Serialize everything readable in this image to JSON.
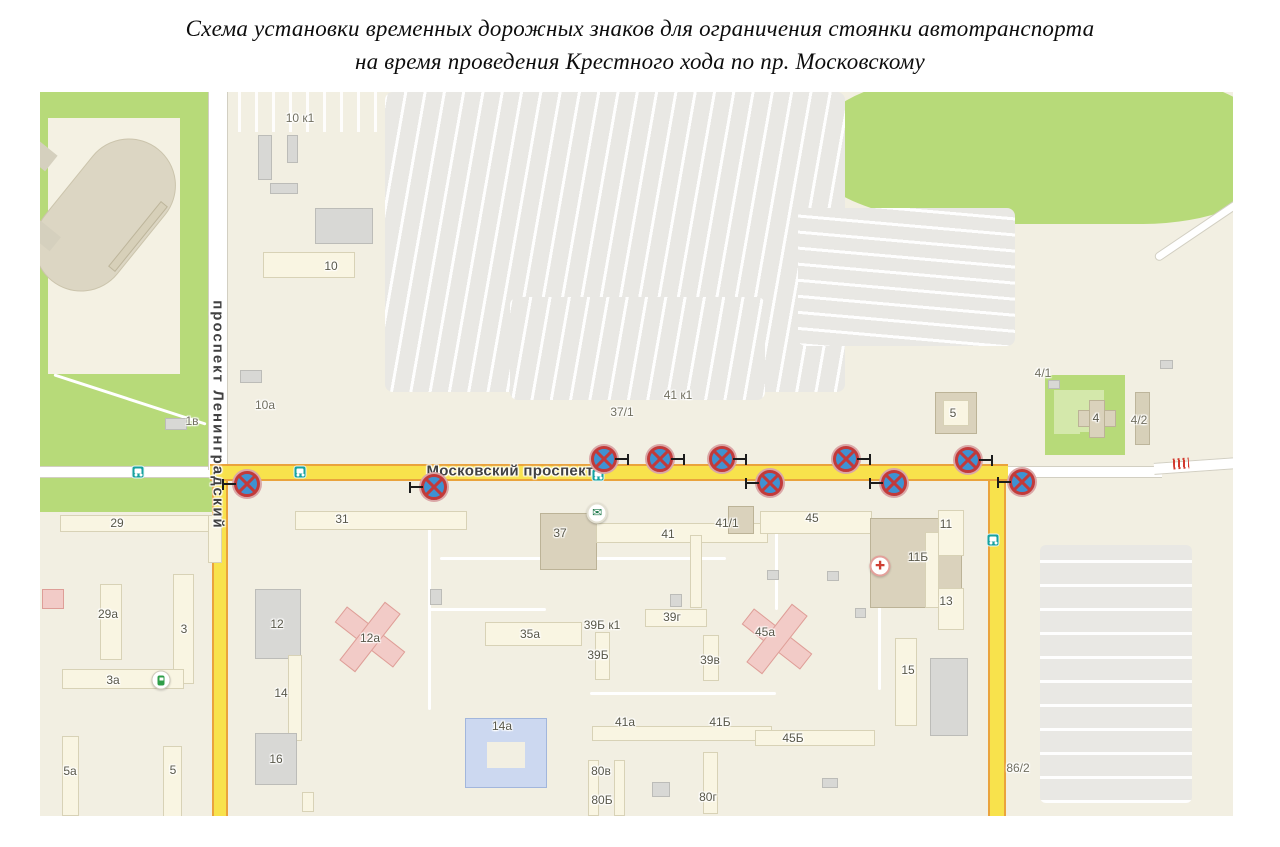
{
  "title": {
    "line1": "Схема установки временных дорожных знаков для ограничения стоянки автотранспорта",
    "line2": "на время проведения Крестного хода по пр. Московскому"
  },
  "map": {
    "colors": {
      "route_fill": "#f8e24c",
      "route_border": "#eaa33c",
      "sign_blue": "#3f92d2",
      "sign_red": "#c23a3a",
      "park_green": "#b7da79",
      "map_bg": "#f2efe2"
    },
    "shapes": [
      {
        "k": "green",
        "n": "park-area",
        "x": 0,
        "y": 0,
        "w": 175,
        "h": 420
      },
      {
        "k": "ivory",
        "n": "stadium-grounds",
        "x": 8,
        "y": 26,
        "w": 132,
        "h": 256
      },
      {
        "k": "oval",
        "n": "stadium-track",
        "x": -20,
        "y": 76,
        "w": 170,
        "h": 94,
        "r": "48px",
        "rot": -51
      },
      {
        "k": "tanbar",
        "n": "grandstand",
        "x": 56,
        "y": 140,
        "w": 84,
        "h": 9,
        "rot": -51
      },
      {
        "k": "grayblk",
        "x": -8,
        "y": 52,
        "w": 20,
        "h": 24,
        "rot": -51
      },
      {
        "k": "grayblk",
        "x": -10,
        "y": 118,
        "w": 18,
        "h": 42,
        "rot": -51
      },
      {
        "k": "path",
        "x": 10,
        "y": 306,
        "w": 160,
        "h": 3,
        "rot": 18
      },
      {
        "k": "green",
        "n": "park-area-northeast",
        "x": 768,
        "y": -14,
        "w": 458,
        "h": 146,
        "r": "45% 40% 42% 58% / 80% 65% 55% 75%"
      },
      {
        "k": "green",
        "n": "green-plot-4",
        "x": 1005,
        "y": 283,
        "w": 80,
        "h": 80
      },
      {
        "k": "greenlight",
        "x": 1014,
        "y": 298,
        "w": 50,
        "h": 44
      },
      {
        "k": "green",
        "x": 1040,
        "y": 340,
        "w": 30,
        "h": 20
      },
      {
        "k": "parking pa",
        "n": "parking-lot-north",
        "x": 345,
        "y": 0,
        "w": 460,
        "h": 300,
        "r": "8px"
      },
      {
        "k": "parking pa",
        "x": 470,
        "y": 205,
        "w": 255,
        "h": 103,
        "r": "8px"
      },
      {
        "k": "parking pb",
        "x": 758,
        "y": 116,
        "w": 217,
        "h": 138,
        "r": "8px"
      },
      {
        "k": "parking pc",
        "n": "parking-lot-south",
        "x": 1000,
        "y": 453,
        "w": 152,
        "h": 258,
        "r": "6px"
      },
      {
        "k": "stripesv",
        "x": 198,
        "y": 0,
        "w": 148,
        "h": 40
      },
      {
        "k": "path",
        "x": 388,
        "y": 426,
        "w": 3,
        "h": 192
      },
      {
        "k": "path",
        "x": 390,
        "y": 516,
        "w": 116,
        "h": 3
      },
      {
        "k": "path",
        "x": 400,
        "y": 465,
        "w": 286,
        "h": 3
      },
      {
        "k": "path",
        "x": 735,
        "y": 428,
        "w": 3,
        "h": 90
      },
      {
        "k": "path",
        "x": 838,
        "y": 514,
        "w": 3,
        "h": 84
      },
      {
        "k": "path",
        "x": 550,
        "y": 600,
        "w": 186,
        "h": 3
      },
      {
        "k": "roadh",
        "n": "road-west",
        "x": 0,
        "y": 374,
        "w": 178,
        "h": 12
      },
      {
        "k": "roadh",
        "n": "road-east",
        "x": 962,
        "y": 374,
        "w": 160,
        "h": 12
      },
      {
        "k": "roadh",
        "n": "road-east-bend",
        "x": 1114,
        "y": 368,
        "w": 82,
        "h": 12,
        "rot": -4
      },
      {
        "k": "roadv",
        "n": "road-leningradsky",
        "x": 168,
        "y": 0,
        "w": 20,
        "h": 378
      },
      {
        "k": "roaddiag",
        "n": "road-northeast",
        "x": 1106,
        "y": 131,
        "w": 112,
        "h": 9,
        "rot": -34,
        "r": "5px"
      },
      {
        "k": "routev",
        "n": "route-highlight-left",
        "x": 172,
        "y": 374,
        "w": 16,
        "h": 350
      },
      {
        "k": "routev",
        "n": "route-highlight-right",
        "x": 948,
        "y": 374,
        "w": 18,
        "h": 350
      },
      {
        "k": "routeh",
        "n": "route-highlight-moskovsky",
        "x": 170,
        "y": 372,
        "w": 798,
        "h": 17
      },
      {
        "k": "hatch",
        "n": "crossing-marker",
        "x": 1133,
        "y": 366,
        "w": 16,
        "h": 11,
        "rot": -4
      },
      {
        "k": "gray",
        "x": 218,
        "y": 43,
        "w": 14,
        "h": 45
      },
      {
        "k": "gray",
        "x": 247,
        "y": 43,
        "w": 11,
        "h": 28
      },
      {
        "k": "gray",
        "x": 230,
        "y": 91,
        "w": 28,
        "h": 11
      },
      {
        "k": "gray",
        "x": 275,
        "y": 116,
        "w": 58,
        "h": 36
      },
      {
        "k": "pale",
        "n": "building-10",
        "x": 223,
        "y": 160,
        "w": 92,
        "h": 26
      },
      {
        "k": "gray",
        "x": 200,
        "y": 278,
        "w": 22,
        "h": 13
      },
      {
        "k": "gray",
        "x": 125,
        "y": 326,
        "w": 22,
        "h": 12
      },
      {
        "k": "pale",
        "x": 20,
        "y": 423,
        "w": 162,
        "h": 17
      },
      {
        "k": "pale",
        "x": 168,
        "y": 423,
        "w": 14,
        "h": 48
      },
      {
        "k": "pale",
        "x": 60,
        "y": 492,
        "w": 22,
        "h": 76
      },
      {
        "k": "pink",
        "x": 2,
        "y": 497,
        "w": 22,
        "h": 20
      },
      {
        "k": "pale",
        "x": 133,
        "y": 482,
        "w": 21,
        "h": 110
      },
      {
        "k": "pale",
        "x": 22,
        "y": 577,
        "w": 122,
        "h": 20
      },
      {
        "k": "pale",
        "x": 22,
        "y": 644,
        "w": 17,
        "h": 80
      },
      {
        "k": "pale",
        "x": 123,
        "y": 654,
        "w": 19,
        "h": 78
      },
      {
        "k": "gray",
        "x": 215,
        "y": 497,
        "w": 46,
        "h": 70
      },
      {
        "k": "pale",
        "x": 248,
        "y": 563,
        "w": 14,
        "h": 86
      },
      {
        "k": "gray",
        "x": 215,
        "y": 641,
        "w": 42,
        "h": 52
      },
      {
        "k": "pale",
        "x": 262,
        "y": 700,
        "w": 12,
        "h": 20
      },
      {
        "k": "pale",
        "x": 255,
        "y": 419,
        "w": 172,
        "h": 19
      },
      {
        "k": "tan",
        "n": "building-37",
        "x": 500,
        "y": 421,
        "w": 57,
        "h": 57
      },
      {
        "k": "pale",
        "x": 556,
        "y": 431,
        "w": 172,
        "h": 20
      },
      {
        "k": "pale",
        "x": 445,
        "y": 530,
        "w": 97,
        "h": 24
      },
      {
        "k": "pale",
        "x": 555,
        "y": 540,
        "w": 15,
        "h": 48
      },
      {
        "k": "pale",
        "x": 605,
        "y": 517,
        "w": 62,
        "h": 18
      },
      {
        "k": "pale",
        "x": 663,
        "y": 543,
        "w": 16,
        "h": 46
      },
      {
        "k": "pale",
        "x": 650,
        "y": 443,
        "w": 12,
        "h": 73
      },
      {
        "k": "tan",
        "x": 688,
        "y": 414,
        "w": 26,
        "h": 28
      },
      {
        "k": "pale",
        "x": 720,
        "y": 419,
        "w": 112,
        "h": 23
      },
      {
        "k": "tan",
        "n": "building-11b",
        "x": 830,
        "y": 426,
        "w": 92,
        "h": 90
      },
      {
        "k": "pale",
        "x": 898,
        "y": 418,
        "w": 26,
        "h": 46
      },
      {
        "k": "pale",
        "x": 898,
        "y": 496,
        "w": 26,
        "h": 42
      },
      {
        "k": "pale",
        "x": 885,
        "y": 440,
        "w": 14,
        "h": 76
      },
      {
        "k": "pale",
        "x": 855,
        "y": 546,
        "w": 22,
        "h": 88
      },
      {
        "k": "gray",
        "x": 890,
        "y": 566,
        "w": 38,
        "h": 78
      },
      {
        "k": "pale",
        "x": 552,
        "y": 634,
        "w": 180,
        "h": 15
      },
      {
        "k": "pale",
        "x": 715,
        "y": 638,
        "w": 120,
        "h": 16
      },
      {
        "k": "pale",
        "x": 548,
        "y": 668,
        "w": 11,
        "h": 56
      },
      {
        "k": "pale",
        "x": 574,
        "y": 668,
        "w": 11,
        "h": 56
      },
      {
        "k": "pale",
        "x": 663,
        "y": 660,
        "w": 15,
        "h": 62
      },
      {
        "k": "gray",
        "x": 612,
        "y": 690,
        "w": 18,
        "h": 15
      },
      {
        "k": "gray",
        "x": 782,
        "y": 686,
        "w": 16,
        "h": 10
      },
      {
        "k": "blue",
        "n": "building-14a",
        "x": 425,
        "y": 626,
        "w": 82,
        "h": 70
      },
      {
        "k": "hole",
        "x": 447,
        "y": 650,
        "w": 38,
        "h": 26
      },
      {
        "k": "tan",
        "n": "building-5-right",
        "x": 895,
        "y": 300,
        "w": 42,
        "h": 42
      },
      {
        "k": "pale",
        "x": 903,
        "y": 308,
        "w": 26,
        "h": 26
      },
      {
        "k": "tanbar",
        "x": 1095,
        "y": 300,
        "w": 15,
        "h": 53
      },
      {
        "k": "tan",
        "n": "building-4",
        "x": 1038,
        "y": 318,
        "w": 38,
        "h": 17
      },
      {
        "k": "tan",
        "x": 1049,
        "y": 308,
        "w": 16,
        "h": 38
      },
      {
        "k": "gray",
        "x": 1008,
        "y": 288,
        "w": 12,
        "h": 9
      },
      {
        "k": "gray",
        "x": 1120,
        "y": 268,
        "w": 13,
        "h": 9
      },
      {
        "k": "gray",
        "x": 390,
        "y": 497,
        "w": 12,
        "h": 16
      },
      {
        "k": "gray",
        "x": 630,
        "y": 502,
        "w": 12,
        "h": 13
      },
      {
        "k": "gray",
        "x": 727,
        "y": 478,
        "w": 12,
        "h": 10
      },
      {
        "k": "gray",
        "x": 787,
        "y": 479,
        "w": 12,
        "h": 10
      },
      {
        "k": "gray",
        "x": 815,
        "y": 516,
        "w": 11,
        "h": 10
      },
      {
        "k": "pink",
        "n": "building-12a",
        "x": 293,
        "y": 535,
        "w": 74,
        "h": 20,
        "rot": 38
      },
      {
        "k": "pink",
        "x": 320,
        "y": 508,
        "w": 20,
        "h": 74,
        "rot": 38
      },
      {
        "k": "pink",
        "n": "building-45a",
        "x": 700,
        "y": 537,
        "w": 74,
        "h": 20,
        "rot": 38
      },
      {
        "k": "pink",
        "x": 727,
        "y": 510,
        "w": 20,
        "h": 74,
        "rot": 38
      }
    ],
    "labels": [
      {
        "t": "Московский проспект",
        "x": 470,
        "y": 379,
        "cls": "street",
        "n": "street-label-moskovsky-prospekt"
      },
      {
        "t": "проспект Ленинградский",
        "x": 178,
        "y": 323,
        "cls": "vstreet",
        "n": "street-label-prospekt-leningradsky"
      },
      {
        "t": "10 к1",
        "x": 260,
        "y": 26,
        "cls": "plot"
      },
      {
        "t": "10",
        "x": 291,
        "y": 174
      },
      {
        "t": "10а",
        "x": 225,
        "y": 313,
        "cls": "plot"
      },
      {
        "t": "1в",
        "x": 152,
        "y": 329,
        "cls": "plot"
      },
      {
        "t": "37/1",
        "x": 582,
        "y": 320,
        "cls": "plot"
      },
      {
        "t": "41 к1",
        "x": 638,
        "y": 303,
        "cls": "plot"
      },
      {
        "t": "4/1",
        "x": 1003,
        "y": 281,
        "cls": "plot"
      },
      {
        "t": "4",
        "x": 1056,
        "y": 326
      },
      {
        "t": "4/2",
        "x": 1099,
        "y": 328,
        "cls": "plot"
      },
      {
        "t": "5",
        "x": 913,
        "y": 321
      },
      {
        "t": "29",
        "x": 77,
        "y": 431
      },
      {
        "t": "29а",
        "x": 68,
        "y": 522
      },
      {
        "t": "3",
        "x": 144,
        "y": 537
      },
      {
        "t": "3а",
        "x": 73,
        "y": 588
      },
      {
        "t": "5а",
        "x": 30,
        "y": 679
      },
      {
        "t": "5",
        "x": 133,
        "y": 678
      },
      {
        "t": "12",
        "x": 237,
        "y": 532
      },
      {
        "t": "14",
        "x": 241,
        "y": 601
      },
      {
        "t": "16",
        "x": 236,
        "y": 667
      },
      {
        "t": "31",
        "x": 302,
        "y": 427
      },
      {
        "t": "12а",
        "x": 330,
        "y": 546
      },
      {
        "t": "35а",
        "x": 490,
        "y": 542
      },
      {
        "t": "37",
        "x": 520,
        "y": 441
      },
      {
        "t": "41",
        "x": 628,
        "y": 442
      },
      {
        "t": "39Б к1",
        "x": 562,
        "y": 533
      },
      {
        "t": "39Б",
        "x": 558,
        "y": 563
      },
      {
        "t": "39г",
        "x": 632,
        "y": 525
      },
      {
        "t": "39в",
        "x": 670,
        "y": 568
      },
      {
        "t": "41/1",
        "x": 687,
        "y": 431
      },
      {
        "t": "45",
        "x": 772,
        "y": 426
      },
      {
        "t": "45а",
        "x": 725,
        "y": 540
      },
      {
        "t": "11Б",
        "x": 878,
        "y": 465
      },
      {
        "t": "11",
        "x": 906,
        "y": 432
      },
      {
        "t": "13",
        "x": 906,
        "y": 509
      },
      {
        "t": "15",
        "x": 868,
        "y": 578
      },
      {
        "t": "41а",
        "x": 585,
        "y": 630
      },
      {
        "t": "41Б",
        "x": 680,
        "y": 630
      },
      {
        "t": "45Б",
        "x": 753,
        "y": 646
      },
      {
        "t": "80в",
        "x": 561,
        "y": 679
      },
      {
        "t": "80Б",
        "x": 562,
        "y": 708
      },
      {
        "t": "80г",
        "x": 668,
        "y": 705
      },
      {
        "t": "14а",
        "x": 462,
        "y": 634
      },
      {
        "t": "86/2",
        "x": 978,
        "y": 676,
        "cls": "plot"
      }
    ],
    "icons": [
      {
        "k": "bus",
        "x": 98,
        "y": 380
      },
      {
        "k": "bus",
        "x": 260,
        "y": 380
      },
      {
        "k": "bus",
        "x": 558,
        "y": 383
      },
      {
        "k": "bus",
        "x": 953,
        "y": 448
      },
      {
        "k": "post",
        "x": 557,
        "y": 421,
        "g": "✉"
      },
      {
        "k": "pharm",
        "x": 840,
        "y": 474,
        "g": "✚"
      },
      {
        "k": "fuel",
        "x": 121,
        "y": 588
      }
    ],
    "signs": [
      {
        "x": 207,
        "y": 392,
        "b": "left"
      },
      {
        "x": 394,
        "y": 395,
        "b": "left"
      },
      {
        "x": 564,
        "y": 367,
        "b": "right"
      },
      {
        "x": 620,
        "y": 367,
        "b": "right"
      },
      {
        "x": 682,
        "y": 367,
        "b": "right"
      },
      {
        "x": 730,
        "y": 391,
        "b": "left"
      },
      {
        "x": 806,
        "y": 367,
        "b": "right"
      },
      {
        "x": 854,
        "y": 391,
        "b": "left"
      },
      {
        "x": 928,
        "y": 368,
        "b": "right"
      },
      {
        "x": 982,
        "y": 390,
        "b": "left"
      }
    ]
  }
}
